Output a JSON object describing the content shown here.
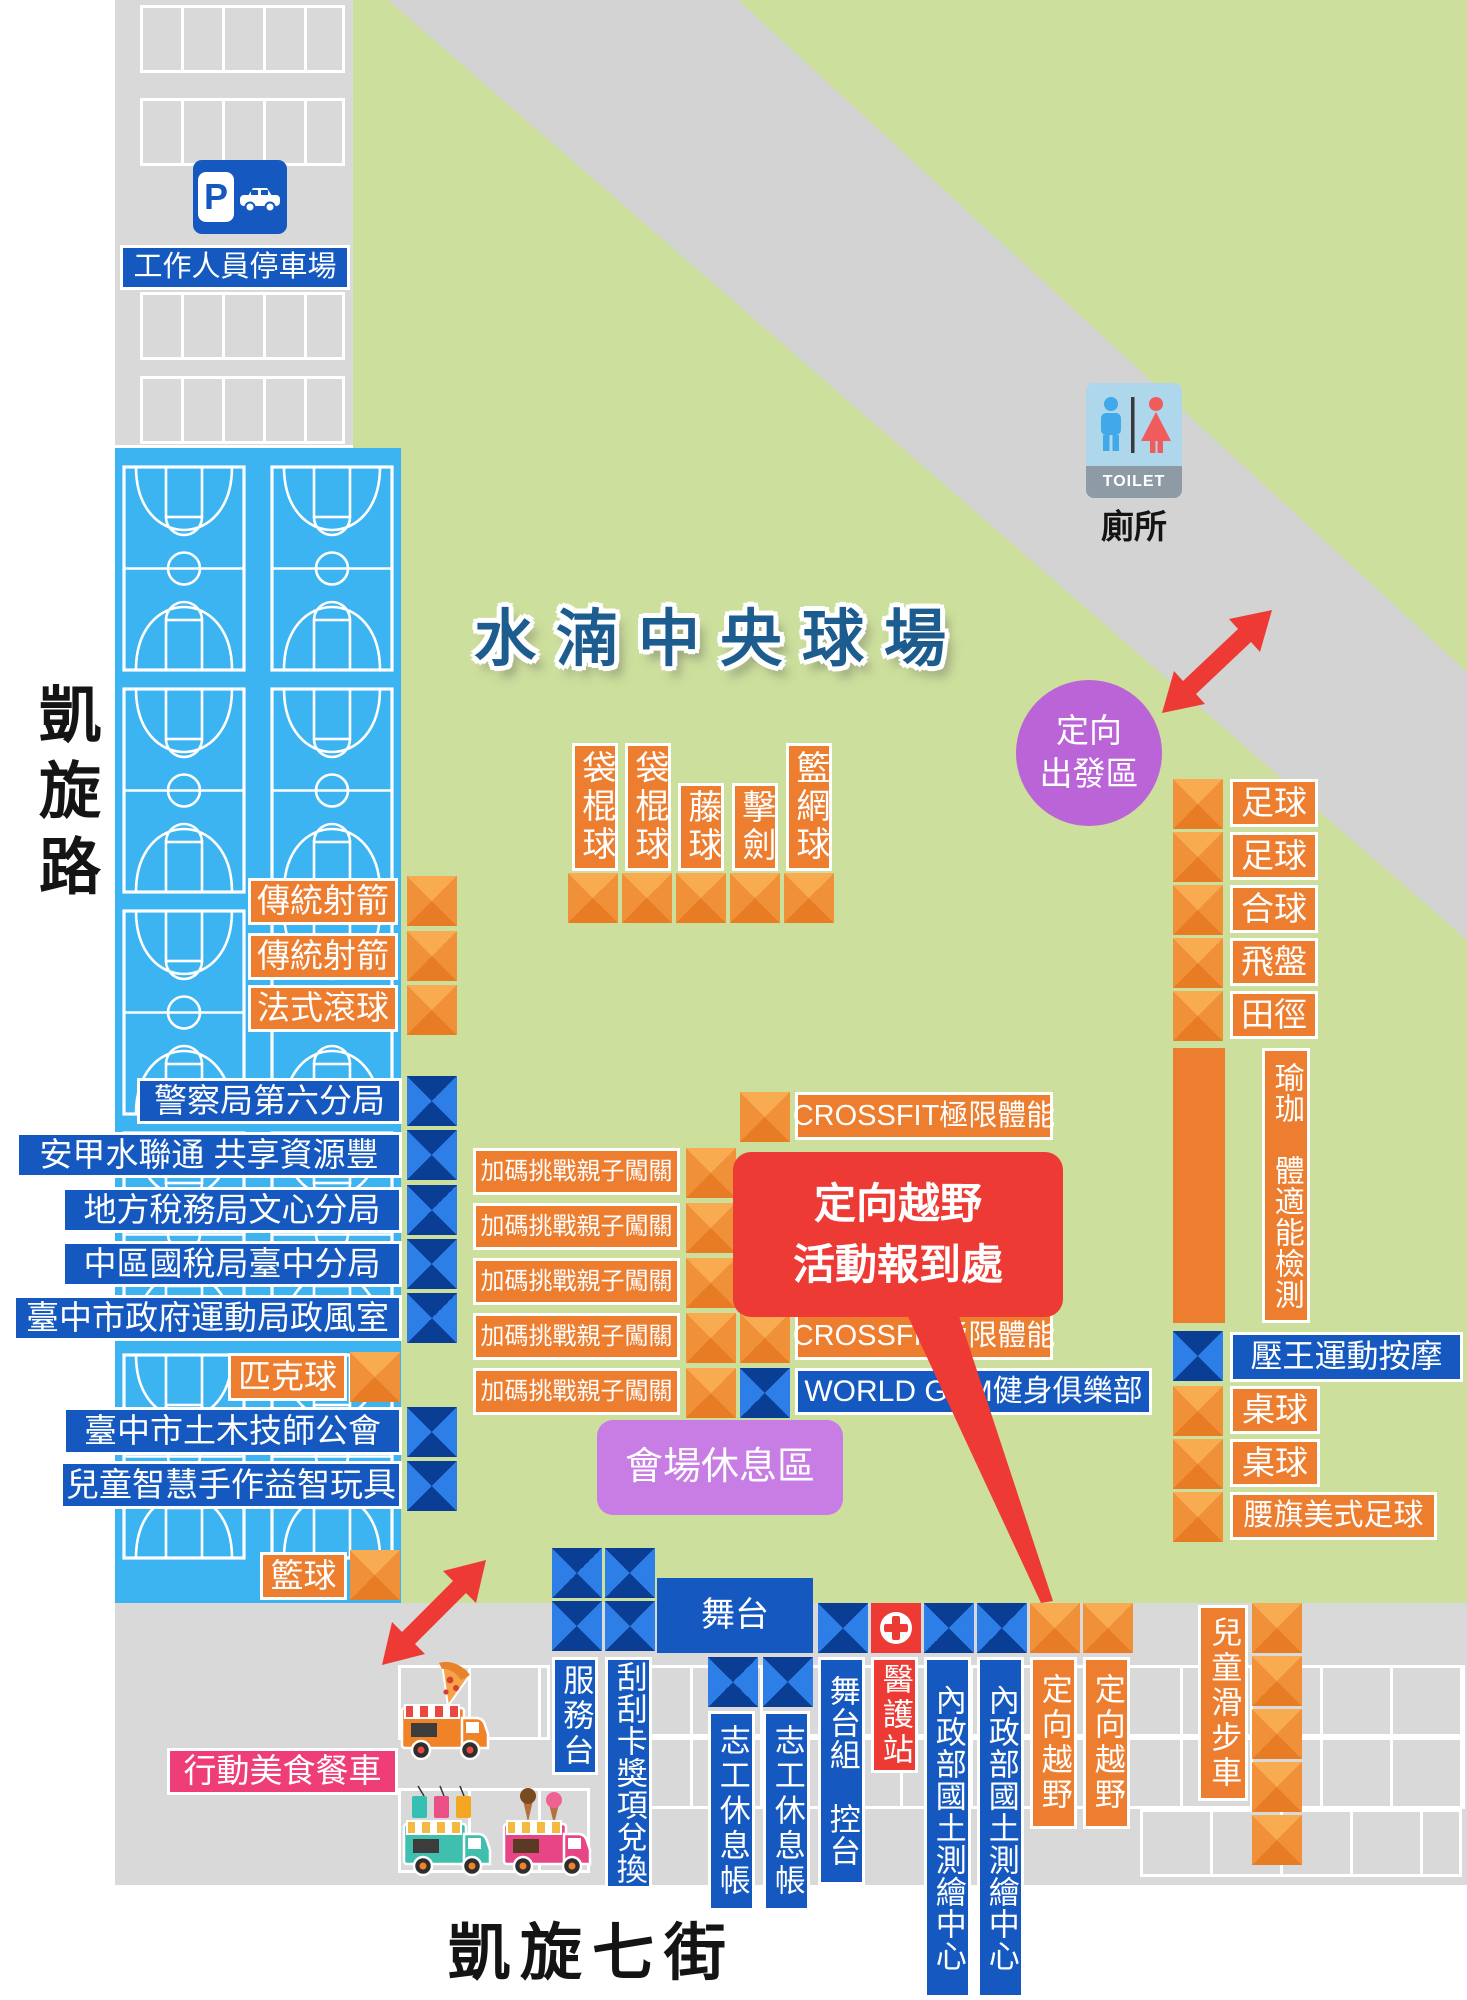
{
  "title": "水湳中央球場",
  "roads": {
    "left": "凱旋路",
    "bottom": "凱旋七街"
  },
  "parking": {
    "sign_letter": "P",
    "label": "工作人員停車場"
  },
  "toilet": {
    "sign": "TOILET",
    "label": "廁所"
  },
  "start_zone": {
    "line1": "定向",
    "line2": "出發區"
  },
  "checkin": {
    "line1": "定向越野",
    "line2": "活動報到處"
  },
  "rest_area": "會場休息區",
  "food_trucks": "行動美食餐車",
  "stage": "舞台",
  "booths": {
    "archery": [
      "傳統射箭",
      "傳統射箭",
      "法式滾球"
    ],
    "gov": [
      "警察局第六分局",
      "安甲水聯通 共享資源豐",
      "地方稅務局文心分局",
      "中區國稅局臺中分局",
      "臺中市政府運動局政風室"
    ],
    "pickleball": "匹克球",
    "civil": [
      "臺中市土木技師公會",
      "兒童智慧手作益智玩具"
    ],
    "basketball": "籃球",
    "vertical_games": [
      "袋棍球",
      "袋棍球",
      "藤球",
      "擊劍",
      "籃網球"
    ],
    "challenge": [
      "加碼挑戰親子闖關",
      "加碼挑戰親子闖關",
      "加碼挑戰親子闖關",
      "加碼挑戰親子闖關",
      "加碼挑戰親子闖關"
    ],
    "crossfit_top": "CROSSFIT極限體能",
    "crossfit_bottom": "CROSSFIT極限體能",
    "world_gym": "WORLD GYM健身俱樂部",
    "right_games": [
      "足球",
      "足球",
      "合球",
      "飛盤",
      "田徑"
    ],
    "yoga": "瑜珈　體適能檢測",
    "massage": "壓王運動按摩",
    "table_tennis": [
      "桌球",
      "桌球"
    ],
    "flag_football": "腰旗美式足球",
    "service_desk": "服務台",
    "scratch_card": "刮刮卡獎項兌換",
    "volunteer": [
      "志工休息帳",
      "志工休息帳"
    ],
    "stage_control": "舞台組　控台",
    "medical": "醫護站",
    "land_survey": [
      "內政部國土測繪中心",
      "內政部國土測繪中心"
    ],
    "orienteering": [
      "定向越野",
      "定向越野"
    ],
    "kids_bike": "兒童滑步車"
  },
  "colors": {
    "booth_orange": "#ed7d2f",
    "booth_blue": "#1559c0",
    "alert_red": "#ee3a34",
    "purple_circle": "#bb64d8",
    "purple_rest": "#c77de4",
    "pink": "#ee3d77",
    "court_blue": "#3db4f2",
    "field_green": "#cddf9c",
    "road_gray": "#d9d9d9",
    "title_blue": "#1d5c8e"
  }
}
